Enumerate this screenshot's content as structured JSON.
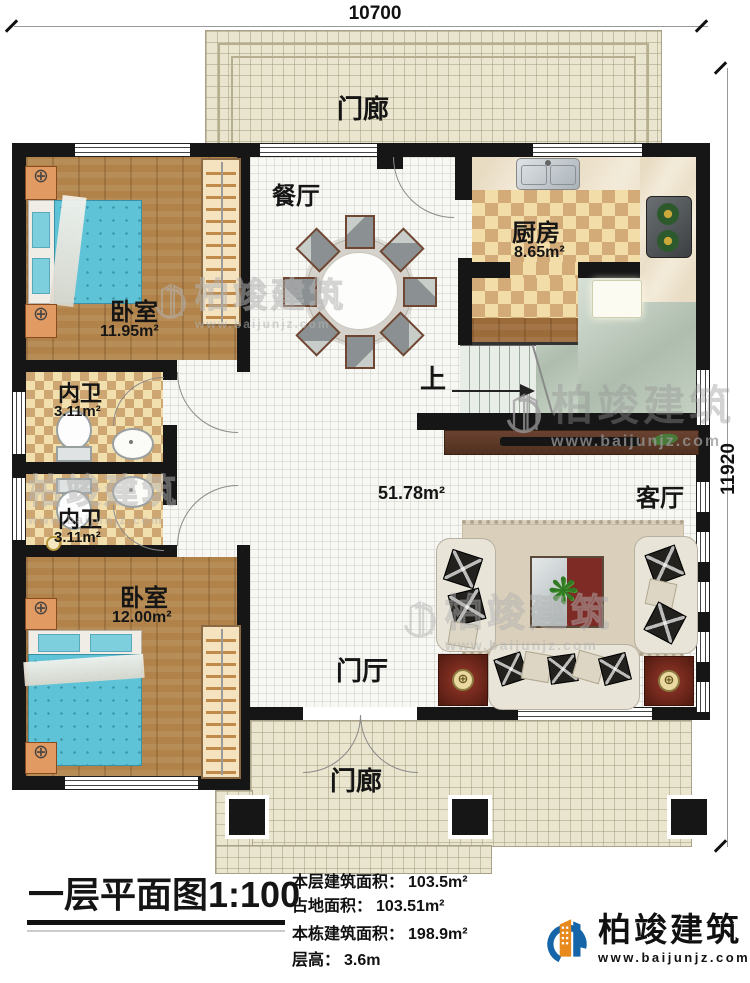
{
  "dimensions": {
    "top": "10700",
    "right": "11920"
  },
  "rooms": {
    "porch_top": "门廊",
    "porch_bottom": "门廊",
    "dining": "餐厅",
    "kitchen": {
      "name": "厨房",
      "area": "8.65m²"
    },
    "bedroom_top": {
      "name": "卧室",
      "area": "11.95m²"
    },
    "bath_top": {
      "name": "内卫",
      "area": "3.11m²"
    },
    "bath_bottom": {
      "name": "内卫",
      "area": "3.11m²"
    },
    "bedroom_bottom": {
      "name": "卧室",
      "area": "12.00m²"
    },
    "hall_area": "51.78m²",
    "living": "客厅",
    "foyer": "门厅",
    "stairs_up": "上"
  },
  "title_block": {
    "title": "一层平面图",
    "scale": "1:100",
    "stats": [
      {
        "label": "本层建筑面积：",
        "value": "103.5m²"
      },
      {
        "label": "占地面积：",
        "value": "103.51m²"
      },
      {
        "label": "本栋建筑面积：",
        "value": "198.9m²"
      },
      {
        "label": "层高：",
        "value": "3.6m"
      }
    ]
  },
  "brand": {
    "name": "柏竣建筑",
    "website": "www.baijunjz.com",
    "blue": "#1565a8",
    "orange": "#e8891d"
  },
  "watermark": {
    "name": "柏竣建筑",
    "website": "www.baijunjz.com"
  },
  "palette": {
    "wall": "#161616",
    "wood": "#b1834a",
    "porch": "#eae5cf",
    "bed": "#5fc3d8"
  }
}
